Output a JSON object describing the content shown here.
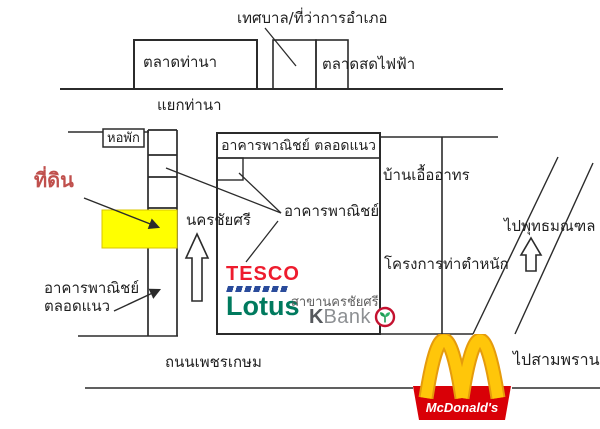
{
  "labels": {
    "municipality": "เทศบาล/ที่ว่าการอำเภอ",
    "market_thana": "ตลาดท่านา",
    "fresh_market": "ตลาดสดไฟฟ้า",
    "junction": "แยกท่านา",
    "dormitory": "หอพัก",
    "land": "ที่ดิน",
    "road_north": "นครชัยศรี",
    "shophouse_row": "อาคารพาณิชย์ ตลอดแนว",
    "commercial": "อาคารพาณิชย์",
    "housing": "บ้านเอื้ออาทร",
    "project": "โครงการท่าตำหนัก",
    "to_phutthamonthon": "ไปพุทธมณฑล",
    "shophouse_line1": "อาคารพาณิชย์",
    "shophouse_line2": "ตลอดแนว",
    "phetkasem_road": "ถนนเพชรเกษม",
    "to_sampran": "ไปสามพราน",
    "branch": "สาขานครชัยศรี"
  },
  "logos": {
    "tesco": "TESCO",
    "lotus": "Lotus",
    "kbank_k": "K",
    "kbank_bank": "Bank",
    "mcdonalds": "McDonald's"
  },
  "colors": {
    "line": "#2b2b2b",
    "land_fill": "#ffff00",
    "land_stroke": "#d8c400",
    "land_label": "#c0504d",
    "tesco_red": "#ee1c2e",
    "lotus_green": "#007a5e",
    "lotus_dash_blue": "#2a4b9b",
    "kbank_dark": "#55585c",
    "kbank_gray": "#8d9093",
    "kbank_circle_red": "#c41230",
    "sprout_green": "#1f9d55",
    "mcd_yellow": "#ffc60a",
    "mcd_red": "#d90007"
  }
}
